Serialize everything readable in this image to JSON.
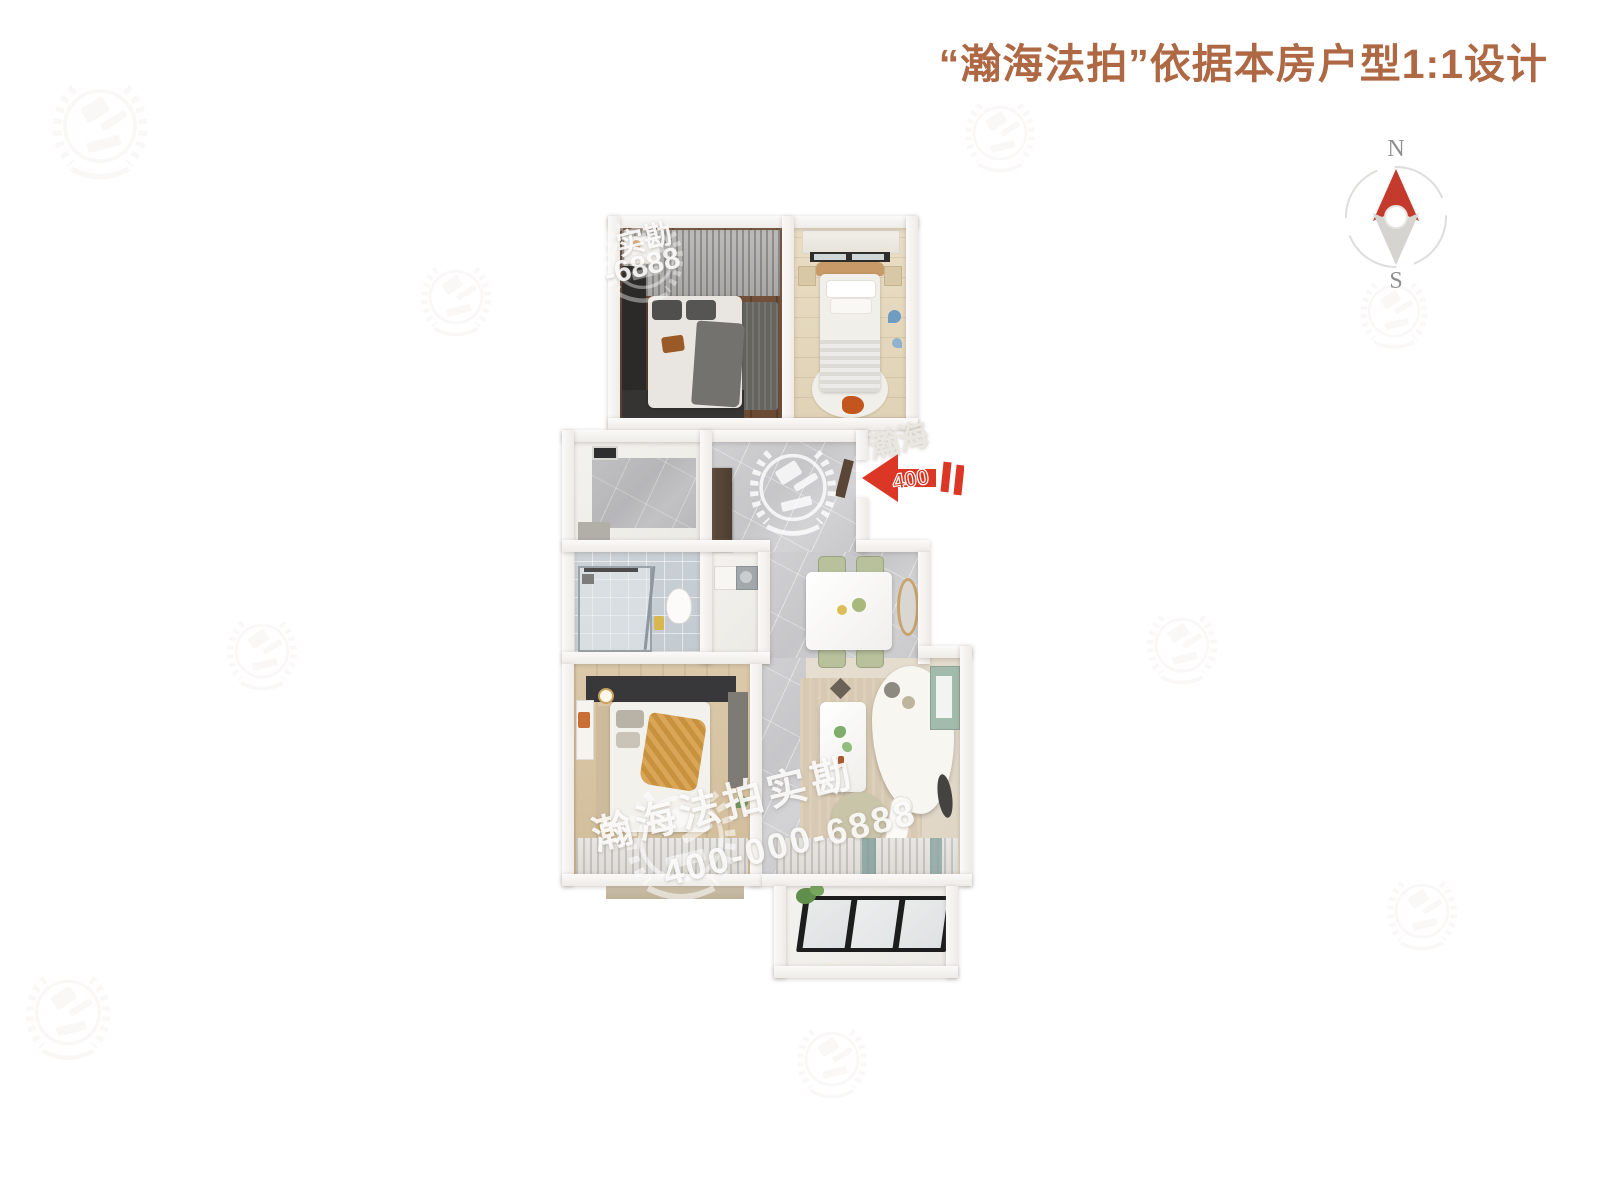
{
  "header": {
    "title": "“瀚海法拍”依据本房户型1:1设计",
    "title_color": "#ae6843"
  },
  "compass": {
    "north_label": "N",
    "south_label": "S",
    "needle_color": "#c43a2c"
  },
  "entrance": {
    "arrow_text": "400",
    "arrow_color": "#dc3726"
  },
  "watermarks": {
    "brand_text": "瀚海法拍实勘",
    "phone_text": "400-000-6888",
    "partial_brand_text": "瀚海",
    "corner_brand_text": "实勘",
    "corner_phone_text": "-6888",
    "logo_icon": "gavel-laurel-logo"
  }
}
